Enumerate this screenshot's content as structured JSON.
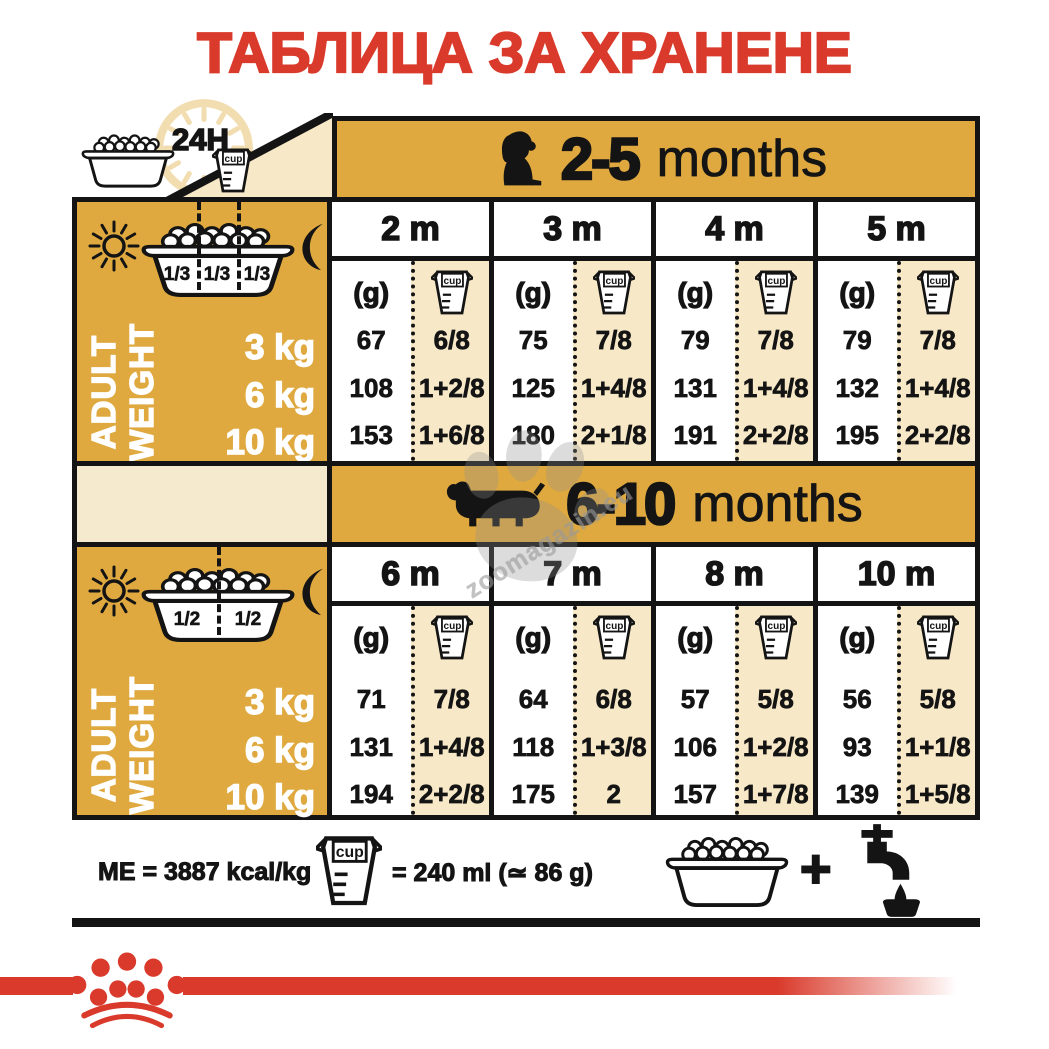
{
  "title": "ТАБЛИЦА ЗА ХРАНЕНЕ",
  "colors": {
    "gold": "#DFA93F",
    "cream": "#F7E8C7",
    "band_cream": "#F5E9CE",
    "red": "#D93A2B",
    "line": "#141414"
  },
  "top": {
    "hours_label": "24H"
  },
  "labels": {
    "cup": "cup",
    "grams": "(g)",
    "adult_line1": "ADULT",
    "adult_line2": "WEIGHT",
    "plus": "+"
  },
  "sections": [
    {
      "age_range": "2-5",
      "months_word": "months",
      "dog_icon": "puppy-silhouette",
      "bowl_fractions": [
        "1/3",
        "1/3",
        "1/3"
      ],
      "weights": [
        "3 kg",
        "6 kg",
        "10 kg"
      ],
      "columns": [
        {
          "month": "2 m",
          "grams": [
            "67",
            "108",
            "153"
          ],
          "cups": [
            "6/8",
            "1+2/8",
            "1+6/8"
          ]
        },
        {
          "month": "3 m",
          "grams": [
            "75",
            "125",
            "180"
          ],
          "cups": [
            "7/8",
            "1+4/8",
            "2+1/8"
          ]
        },
        {
          "month": "4 m",
          "grams": [
            "79",
            "131",
            "191"
          ],
          "cups": [
            "7/8",
            "1+4/8",
            "2+2/8"
          ]
        },
        {
          "month": "5 m",
          "grams": [
            "79",
            "132",
            "195"
          ],
          "cups": [
            "7/8",
            "1+4/8",
            "2+2/8"
          ]
        }
      ]
    },
    {
      "age_range": "6-10",
      "months_word": "months",
      "dog_icon": "dachshund-silhouette",
      "bowl_fractions": [
        "1/2",
        "1/2"
      ],
      "weights": [
        "3 kg",
        "6 kg",
        "10 kg"
      ],
      "columns": [
        {
          "month": "6 m",
          "grams": [
            "71",
            "131",
            "194"
          ],
          "cups": [
            "7/8",
            "1+4/8",
            "2+2/8"
          ]
        },
        {
          "month": "7 m",
          "grams": [
            "64",
            "118",
            "175"
          ],
          "cups": [
            "6/8",
            "1+3/8",
            "2"
          ]
        },
        {
          "month": "8 m",
          "grams": [
            "57",
            "106",
            "157"
          ],
          "cups": [
            "5/8",
            "1+2/8",
            "1+7/8"
          ]
        },
        {
          "month": "10 m",
          "grams": [
            "56",
            "93",
            "139"
          ],
          "cups": [
            "5/8",
            "1+1/8",
            "1+5/8"
          ]
        }
      ]
    }
  ],
  "footer": {
    "me_text": "ME = 3887 kcal/kg",
    "cup_equals_text": "= 240 ml (≃ 86 g)"
  },
  "watermark": {
    "text": "zoomagazin.eu"
  }
}
